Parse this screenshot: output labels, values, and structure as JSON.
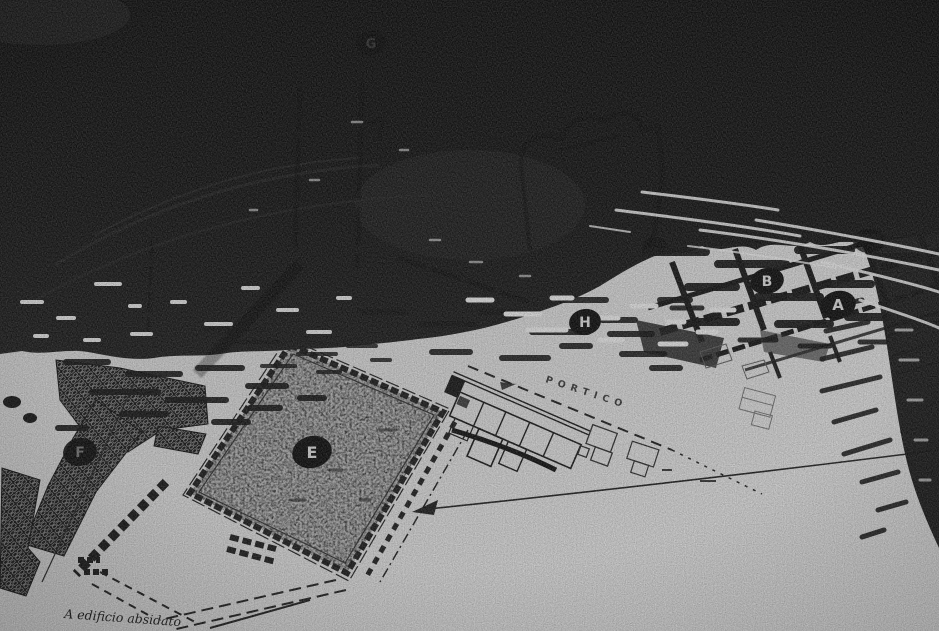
{
  "scene": {
    "description": "Black-and-white photograph of a printed archaeological site plan lying partly beneath dark rippling water",
    "colors": {
      "water": "#131313",
      "paper": "#c6c6c6",
      "ink": "#1c1c1c",
      "marker_bg": "#0d0d0d",
      "marker_text": "#c9c9c9",
      "marker_text_dim": "#6f6f6f",
      "marker_text_faint": "#3d3d3d",
      "ripple_highlight": "#d6d6d6"
    }
  },
  "plan": {
    "portico_label": "PORTICO",
    "caption": "A  edificio absidato",
    "markers": [
      {
        "letter": "A"
      },
      {
        "letter": "B"
      },
      {
        "letter": "E"
      },
      {
        "letter": "F"
      },
      {
        "letter": "G"
      },
      {
        "letter": "H"
      }
    ]
  }
}
